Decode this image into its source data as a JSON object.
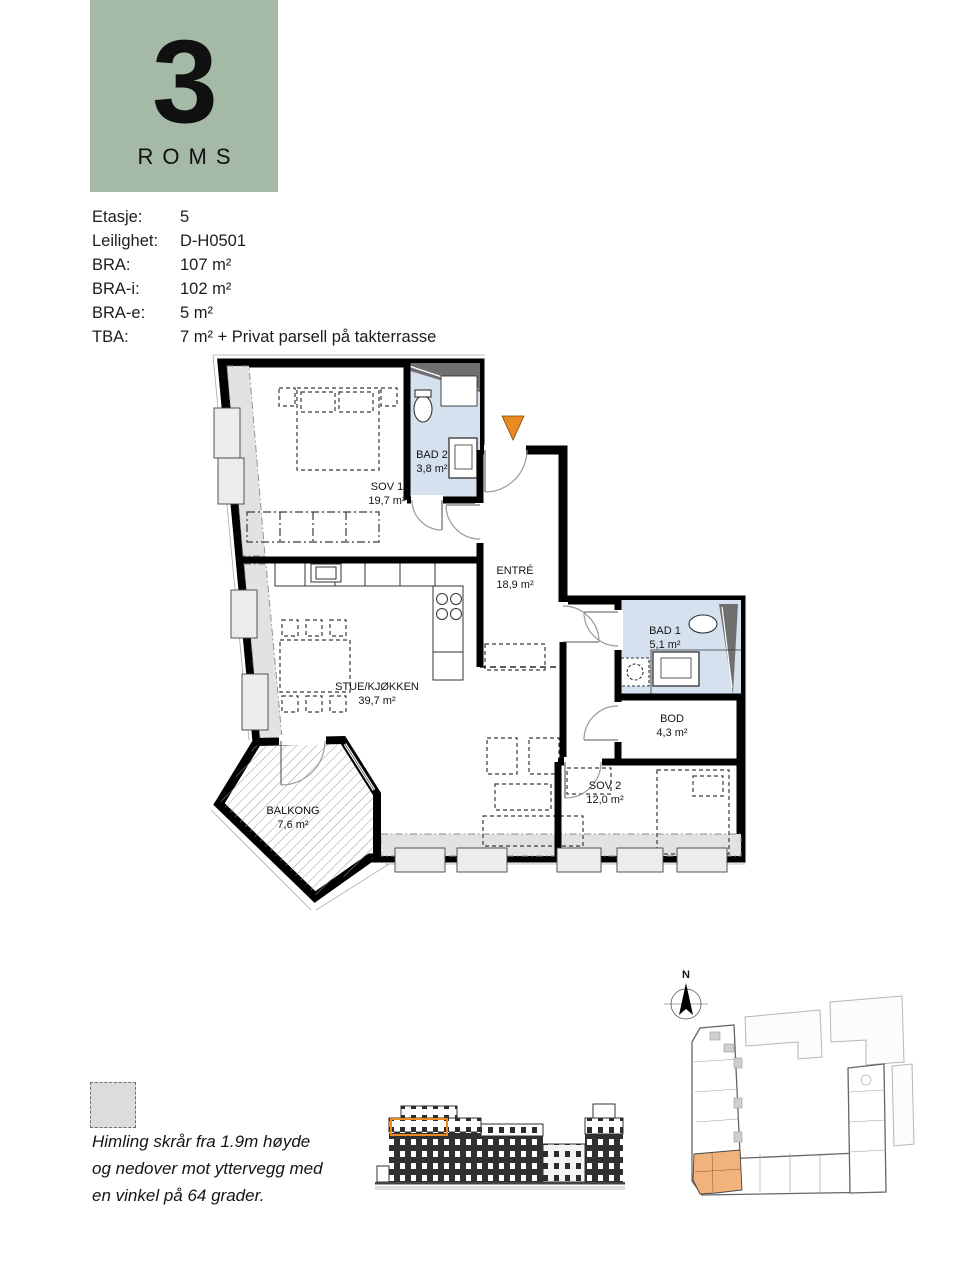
{
  "badge": {
    "number": "3",
    "label": "ROMS",
    "bg_color": "#a5b9a7"
  },
  "info": {
    "rows": [
      {
        "label": "Etasje:",
        "value": "5"
      },
      {
        "label": "Leilighet:",
        "value": "D-H0501"
      },
      {
        "label": "BRA:",
        "value": "107 m²"
      },
      {
        "label": "BRA-i:",
        "value": "102 m²"
      },
      {
        "label": "BRA-e:",
        "value": "5 m²"
      },
      {
        "label": "TBA:",
        "value": "7 m² + Privat parsell på takterrasse"
      }
    ]
  },
  "plan": {
    "marker_color": "#e98b1f",
    "bath_fill": "#d6e1ef",
    "shaft_fill": "#6f6f6f",
    "band_fill": "#e2e2e2",
    "rooms": [
      {
        "name": "SOV 1",
        "area": "19,7 m²"
      },
      {
        "name": "BAD 2",
        "area": "3,8 m²"
      },
      {
        "name": "ENTRÉ",
        "area": "18,9 m²"
      },
      {
        "name": "BAD 1",
        "area": "5,1 m²"
      },
      {
        "name": "BOD",
        "area": "4,3 m²"
      },
      {
        "name": "SOV 2",
        "area": "12,0 m²"
      },
      {
        "name": "STUE/KJØKKEN",
        "area": "39,7 m²"
      },
      {
        "name": "BALKONG",
        "area": "7,6 m²"
      }
    ]
  },
  "legend": {
    "lines": [
      "Himling skrår fra 1.9m høyde",
      "og nedover mot yttervegg med",
      "en vinkel på 64 grader."
    ]
  },
  "elevation": {
    "highlight_color": "#e98b1f"
  },
  "site_plan": {
    "north_label": "N",
    "highlight_color": "#f2b27c"
  }
}
